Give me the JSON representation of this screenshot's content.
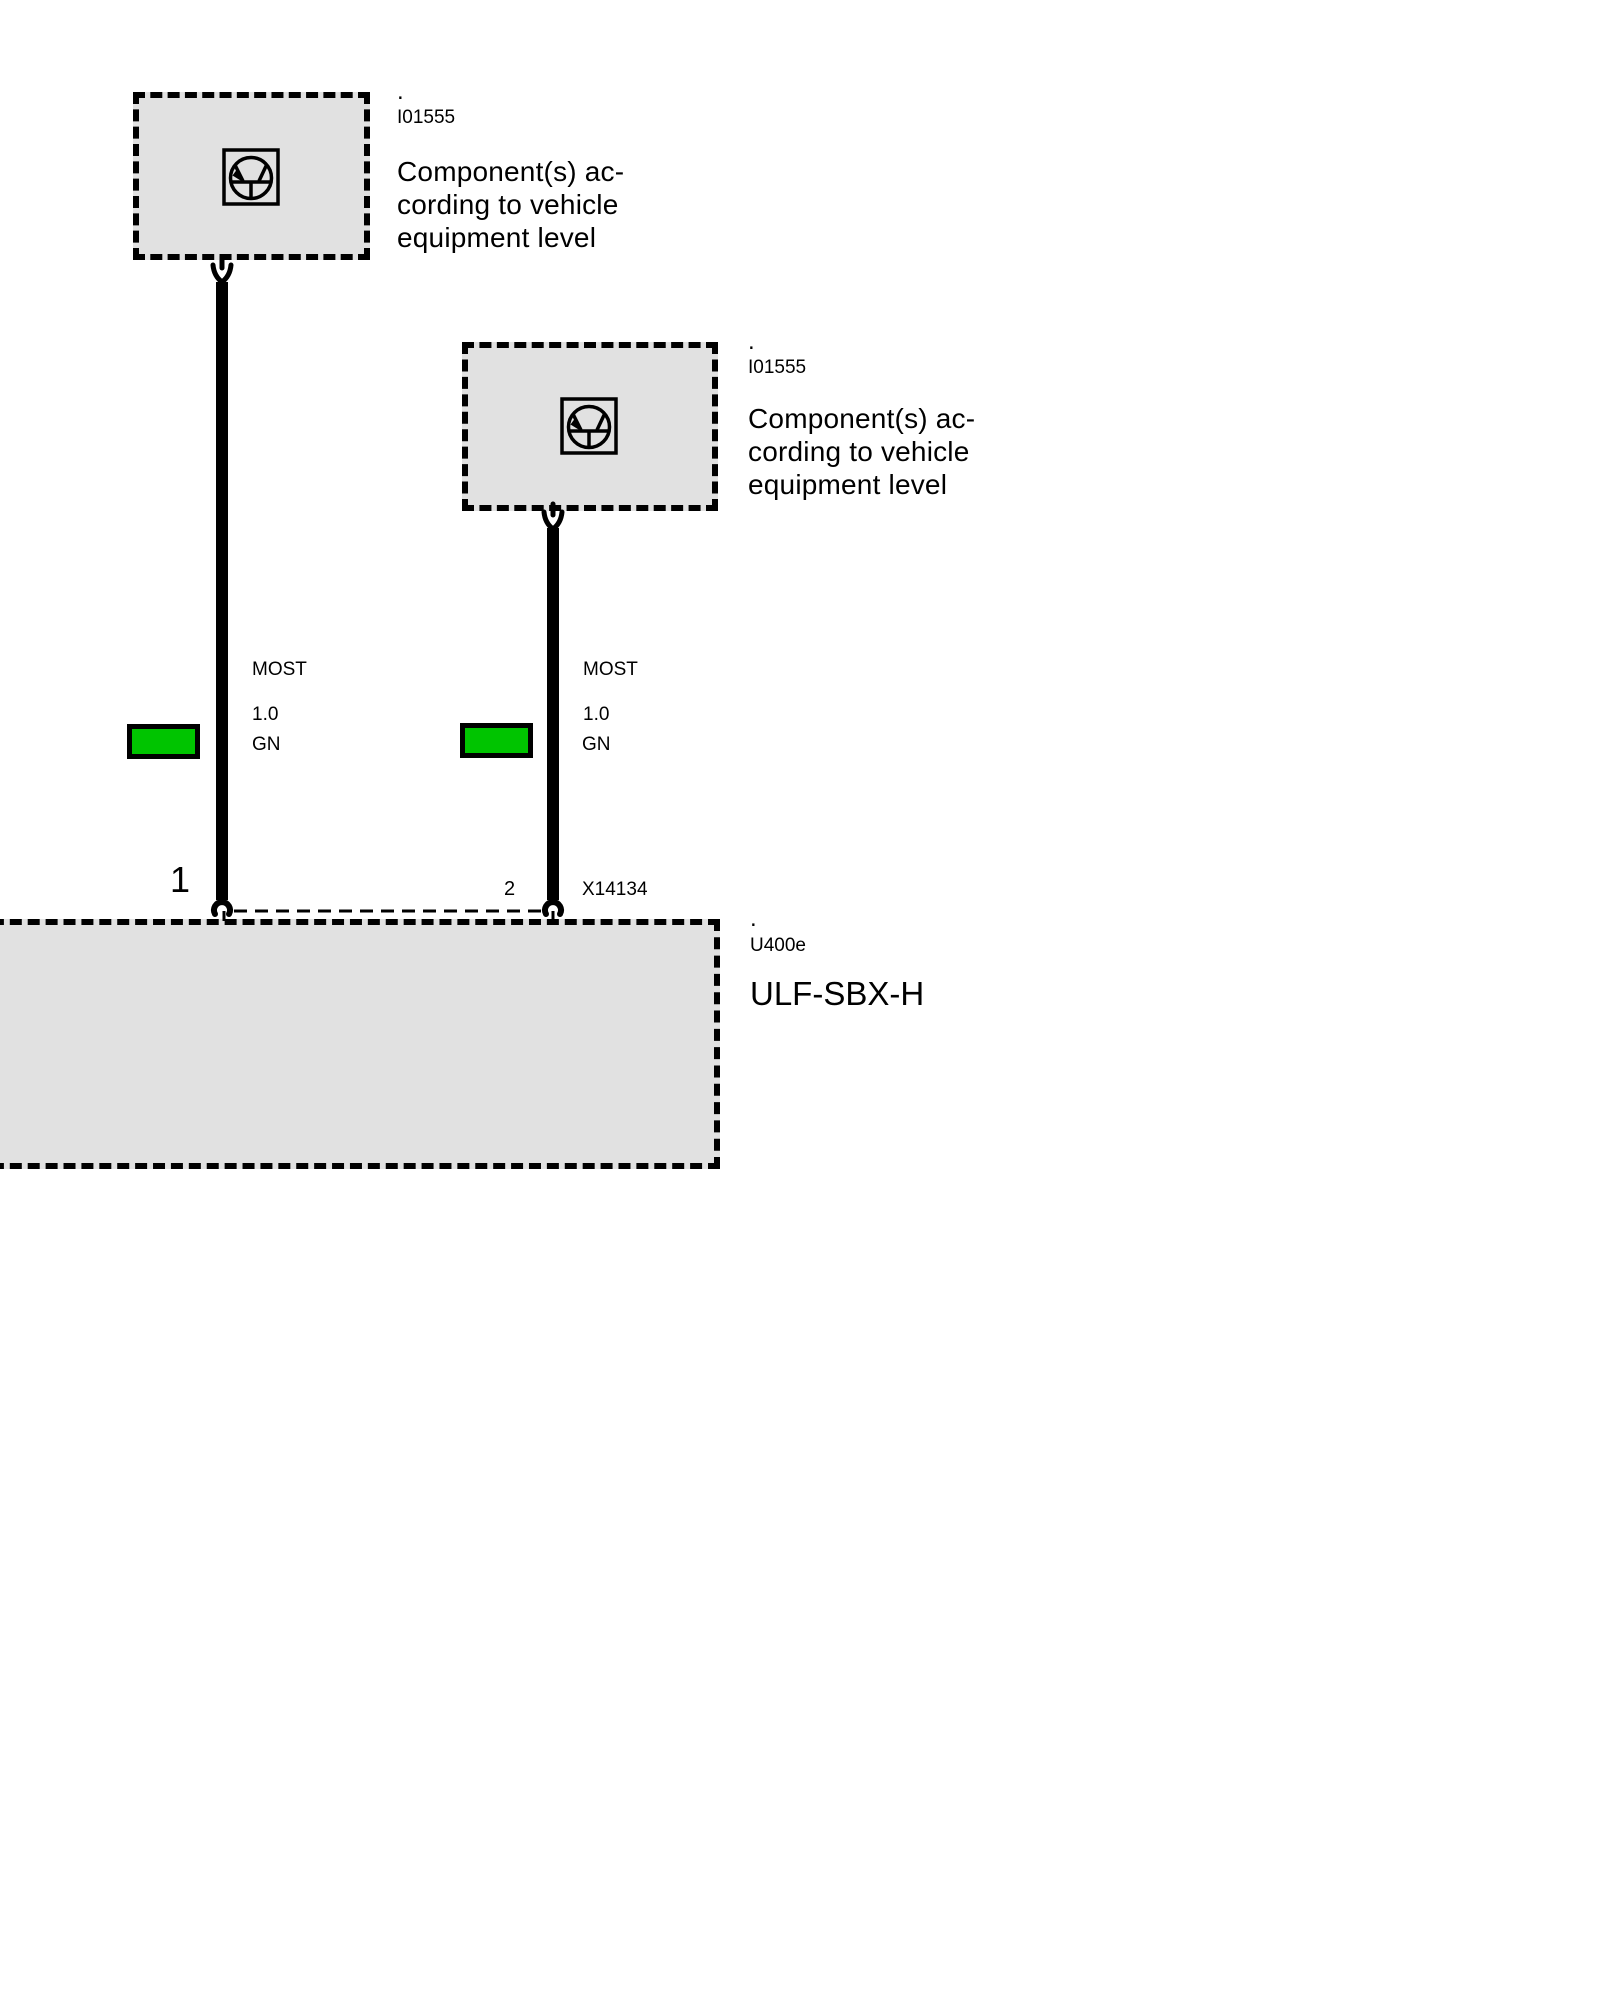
{
  "colors": {
    "background": "#ffffff",
    "box_fill": "#e1e1e1",
    "line": "#000000",
    "wire_green": "#00c400"
  },
  "icons": {
    "component_symbol": "transistor-in-circle-icon",
    "fork_connector": "plug-fork-icon",
    "socket_connector": "socket-arc-icon"
  },
  "components": {
    "top_left": {
      "dot": ".",
      "code": "I01555",
      "name": "Component(s) ac-\ncording to vehicle\nequipment level"
    },
    "top_right": {
      "dot": ".",
      "code": "I01555",
      "name": "Component(s) ac-\ncording to vehicle\nequipment level"
    }
  },
  "control_unit": {
    "dot": ".",
    "code": "U400e",
    "name": "ULF-SBX-H"
  },
  "wires": {
    "left": {
      "bus": "MOST",
      "cross_section": "1.0",
      "color_code": "GN",
      "pin": "1"
    },
    "right": {
      "bus": "MOST",
      "cross_section": "1.0",
      "color_code": "GN",
      "pin": "2",
      "connector": "X14134"
    }
  }
}
